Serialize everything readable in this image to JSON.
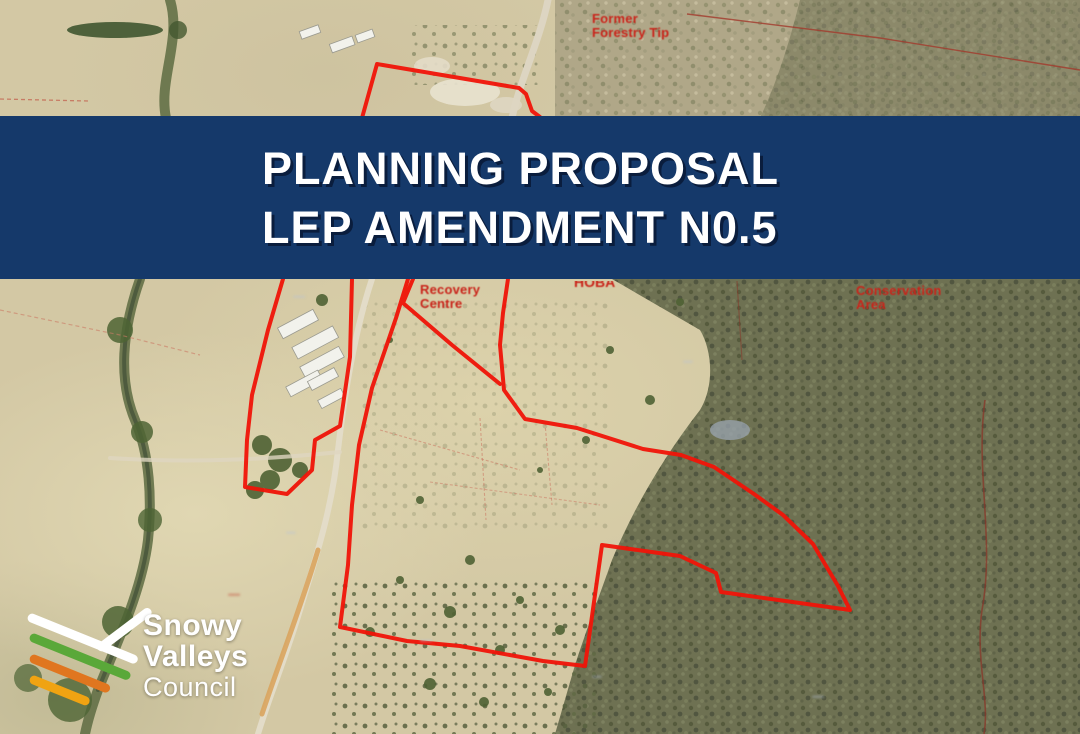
{
  "banner": {
    "line1": "PLANNING PROPOSAL",
    "line2": "LEP AMENDMENT N0.5"
  },
  "logo": {
    "name_line1": "Snowy",
    "name_line2": "Valleys",
    "name_line3": "Council"
  },
  "map_labels": {
    "former_forestry_tip": {
      "line1": "Former",
      "line2": "Forestry Tip"
    },
    "recovery_centre": {
      "line1": "Recovery",
      "line2": "Centre"
    },
    "conservation_area": {
      "line1": "Conservation",
      "line2": "Area"
    },
    "clipped_label": {
      "text": "HOBA"
    },
    "small_red_label": {
      "text": "·····"
    },
    "lot_smudges": [
      "·····",
      "····",
      "·····",
      "····",
      "·····",
      "····"
    ]
  },
  "colors": {
    "banner_bg": "#15396a",
    "banner_text": "#ffffff",
    "boundary_red": "#f01408",
    "label_red": "#c9241a",
    "logo_green": "#5aa839",
    "logo_orange": "#e0761f",
    "logo_yellow": "#f0a312"
  }
}
